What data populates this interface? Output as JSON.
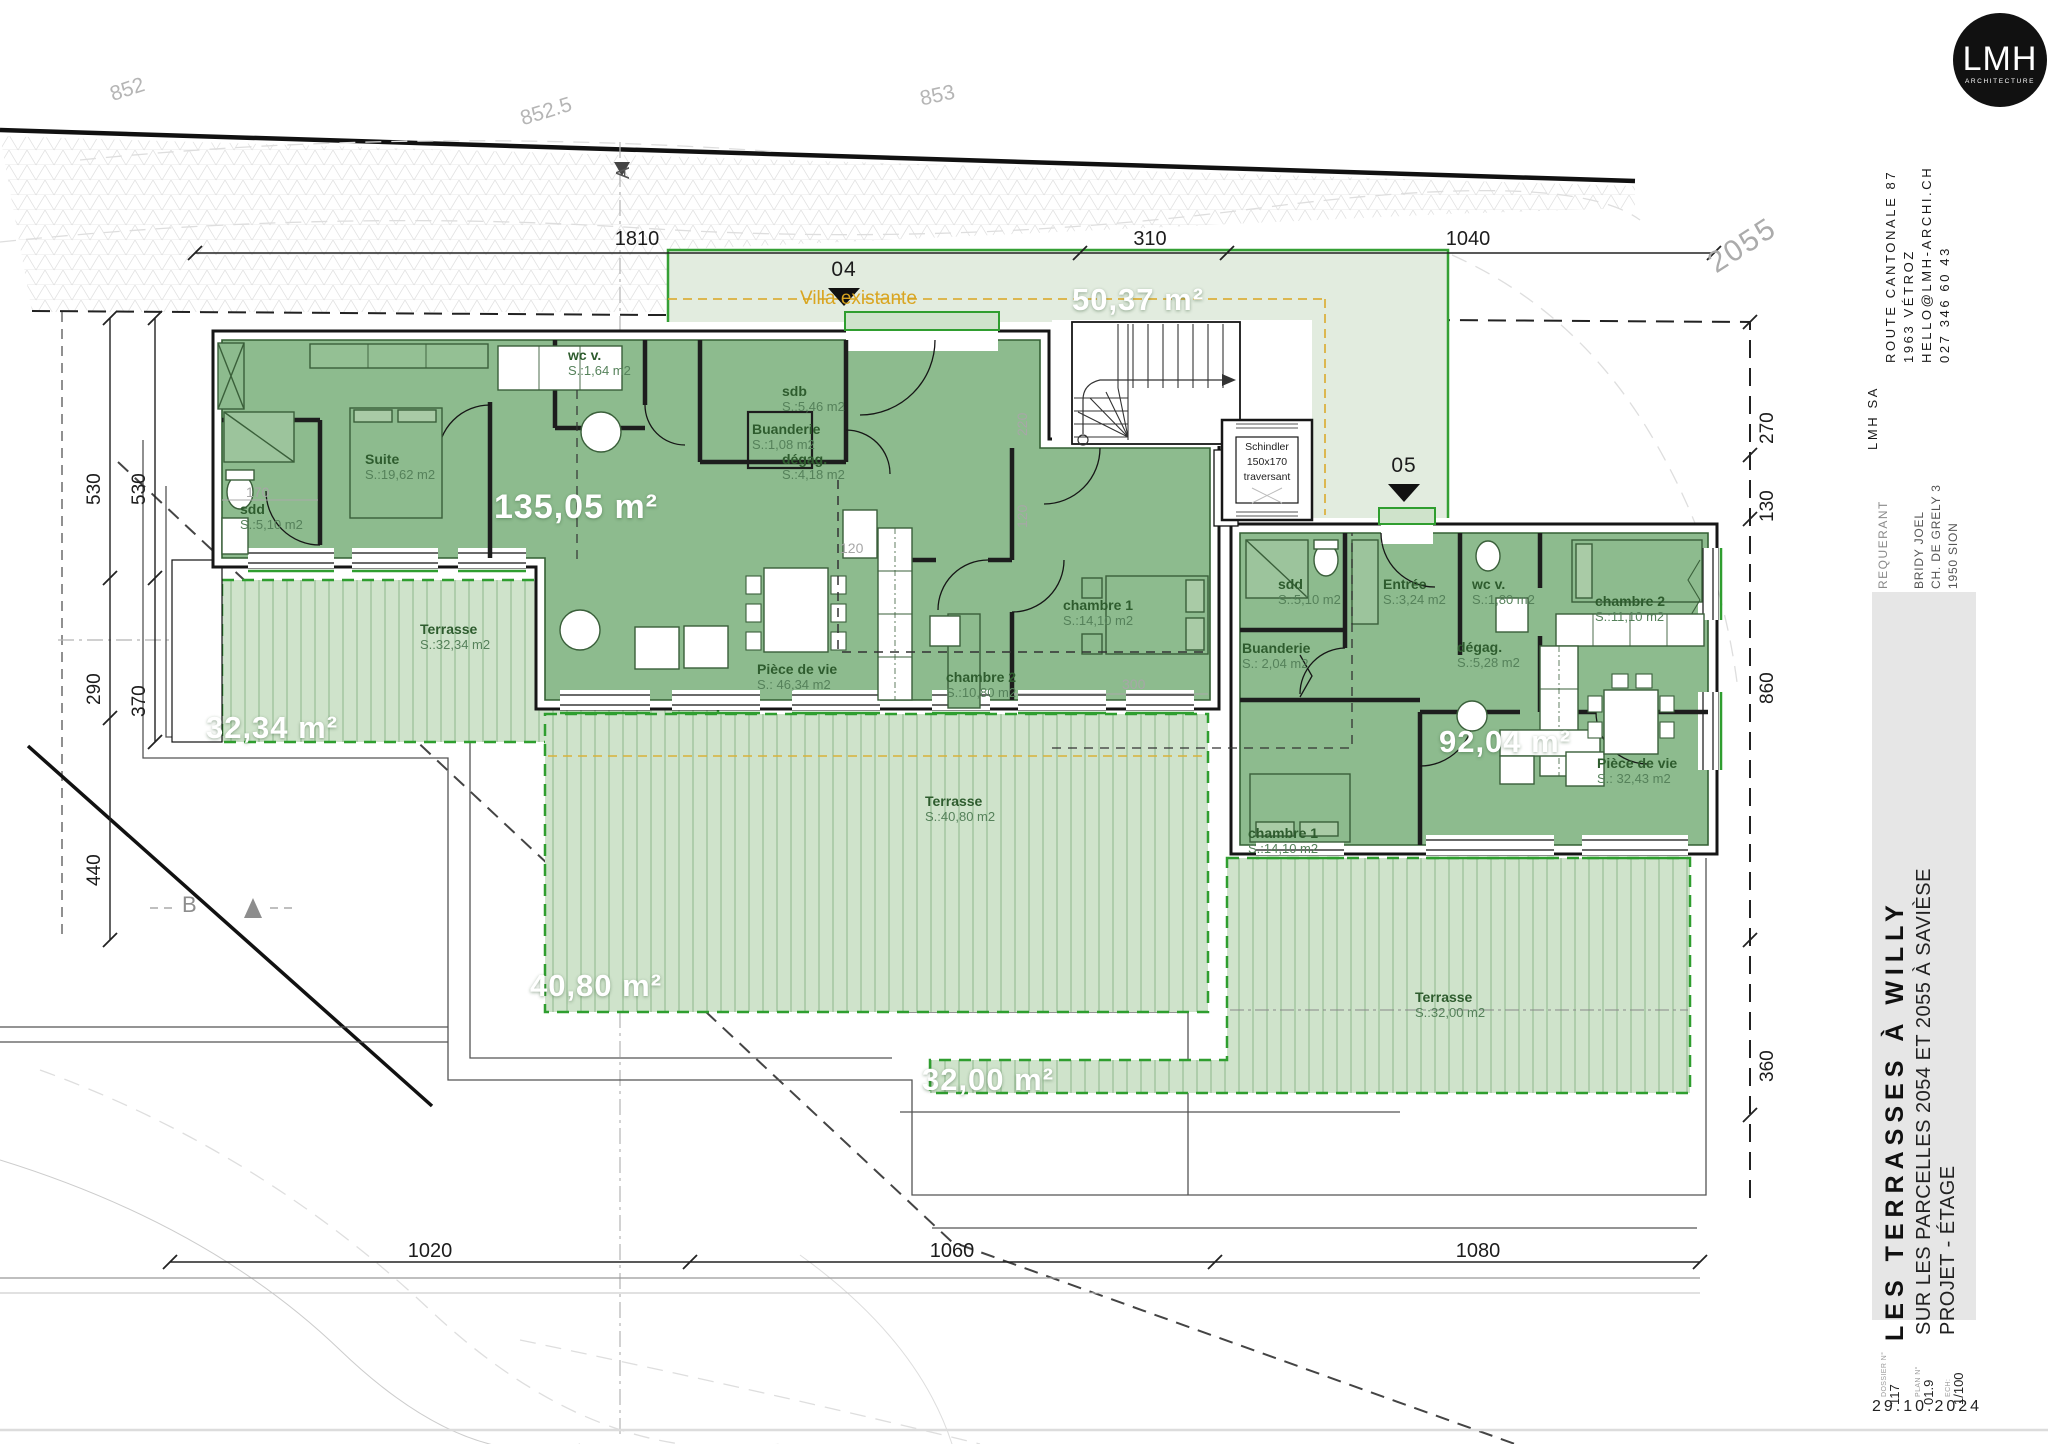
{
  "firm": {
    "logo_big": "LMH",
    "logo_small": "ARCHITECTURE",
    "name": "LMH SA",
    "address": "ROUTE CANTONALE 87",
    "city": "1963 VÉTROZ",
    "email": "HELLO@LMH-ARCHI.CH",
    "phone": "027 346 60 43"
  },
  "requerant": {
    "label": "REQUERANT",
    "name": "BRIDY JOEL",
    "street": "CH. DE GRELY 3",
    "city": "1950 SION"
  },
  "title": {
    "main": "LES TERRASSES À WILLY",
    "sub": "SUR LES PARCELLES 2054 ET 2055 À SAVIÈSE",
    "phase": "PROJET - ÉTAGE"
  },
  "plan_info": {
    "dossier_label": "DOSSIER N°",
    "dossier": "117",
    "plan_label": "PLAN N°",
    "plan": "01.9",
    "scale_label": "ECH:",
    "scale": "1/100",
    "date": "29.10.2024"
  },
  "site": {
    "contours": [
      "852",
      "852.5",
      "853"
    ],
    "parcel_number": "2055",
    "villa_label": "Villa existante",
    "markers": {
      "entry04": "04",
      "entry05": "05",
      "section_a": "A",
      "section_b": "B"
    }
  },
  "areas": {
    "apt04": "135,05 m²",
    "villa": "50,37 m²",
    "apt05": "92,04 m²",
    "terrasse04": "32,34 m²",
    "terrasse_mid": "40,80 m²",
    "terrasse05": "32,00 m²"
  },
  "elevator": {
    "brand": "Schindler",
    "size": "150x170",
    "type": "traversant"
  },
  "rooms": [
    {
      "name": "Suite",
      "area": "S.:19,62 m2"
    },
    {
      "name": "sdd",
      "area": "S.:5,10 m2"
    },
    {
      "name": "wc v.",
      "area": "S.:1,64 m2"
    },
    {
      "name": "sdb",
      "area": "S.:5,46 m2"
    },
    {
      "name": "Buanderie",
      "area": "S.:1,08 m2"
    },
    {
      "name": "dégag.",
      "area": "S.:4,18 m2"
    },
    {
      "name": "Pièce de vie",
      "area": "S.: 46,34 m2"
    },
    {
      "name": "chambre 2",
      "area": "S.:10,80 m2"
    },
    {
      "name": "chambre 1",
      "area": "S.:14,10 m2"
    },
    {
      "name": "sdd",
      "area": "S.:5,10 m2"
    },
    {
      "name": "Entrée",
      "area": "S.:3,24 m2"
    },
    {
      "name": "wc v.",
      "area": "S.:1,80 m2"
    },
    {
      "name": "chambre 2",
      "area": "S.:11,10 m2"
    },
    {
      "name": "Buanderie",
      "area": "S.: 2,04 m2"
    },
    {
      "name": "dégag.",
      "area": "S.:5,28 m2"
    },
    {
      "name": "chambre 1",
      "area": "S.:14,10 m2"
    },
    {
      "name": "Pièce de vie",
      "area": "S.: 32,43 m2"
    },
    {
      "name": "Terrasse",
      "area": "S.:32,34 m2"
    },
    {
      "name": "Terrasse",
      "area": "S.:40,80 m2"
    },
    {
      "name": "Terrasse",
      "area": "S.:32,00 m2"
    }
  ],
  "dimensions": {
    "top": [
      "1810",
      "310",
      "1040"
    ],
    "left_outer": [
      "530",
      "290",
      "440"
    ],
    "left_inner": [
      "530",
      "370"
    ],
    "right": [
      "270",
      "130",
      "860",
      "360"
    ],
    "bottom": [
      "1020",
      "1060",
      "1080"
    ],
    "interior": [
      "170",
      "220",
      "120",
      "120",
      "300"
    ]
  }
}
